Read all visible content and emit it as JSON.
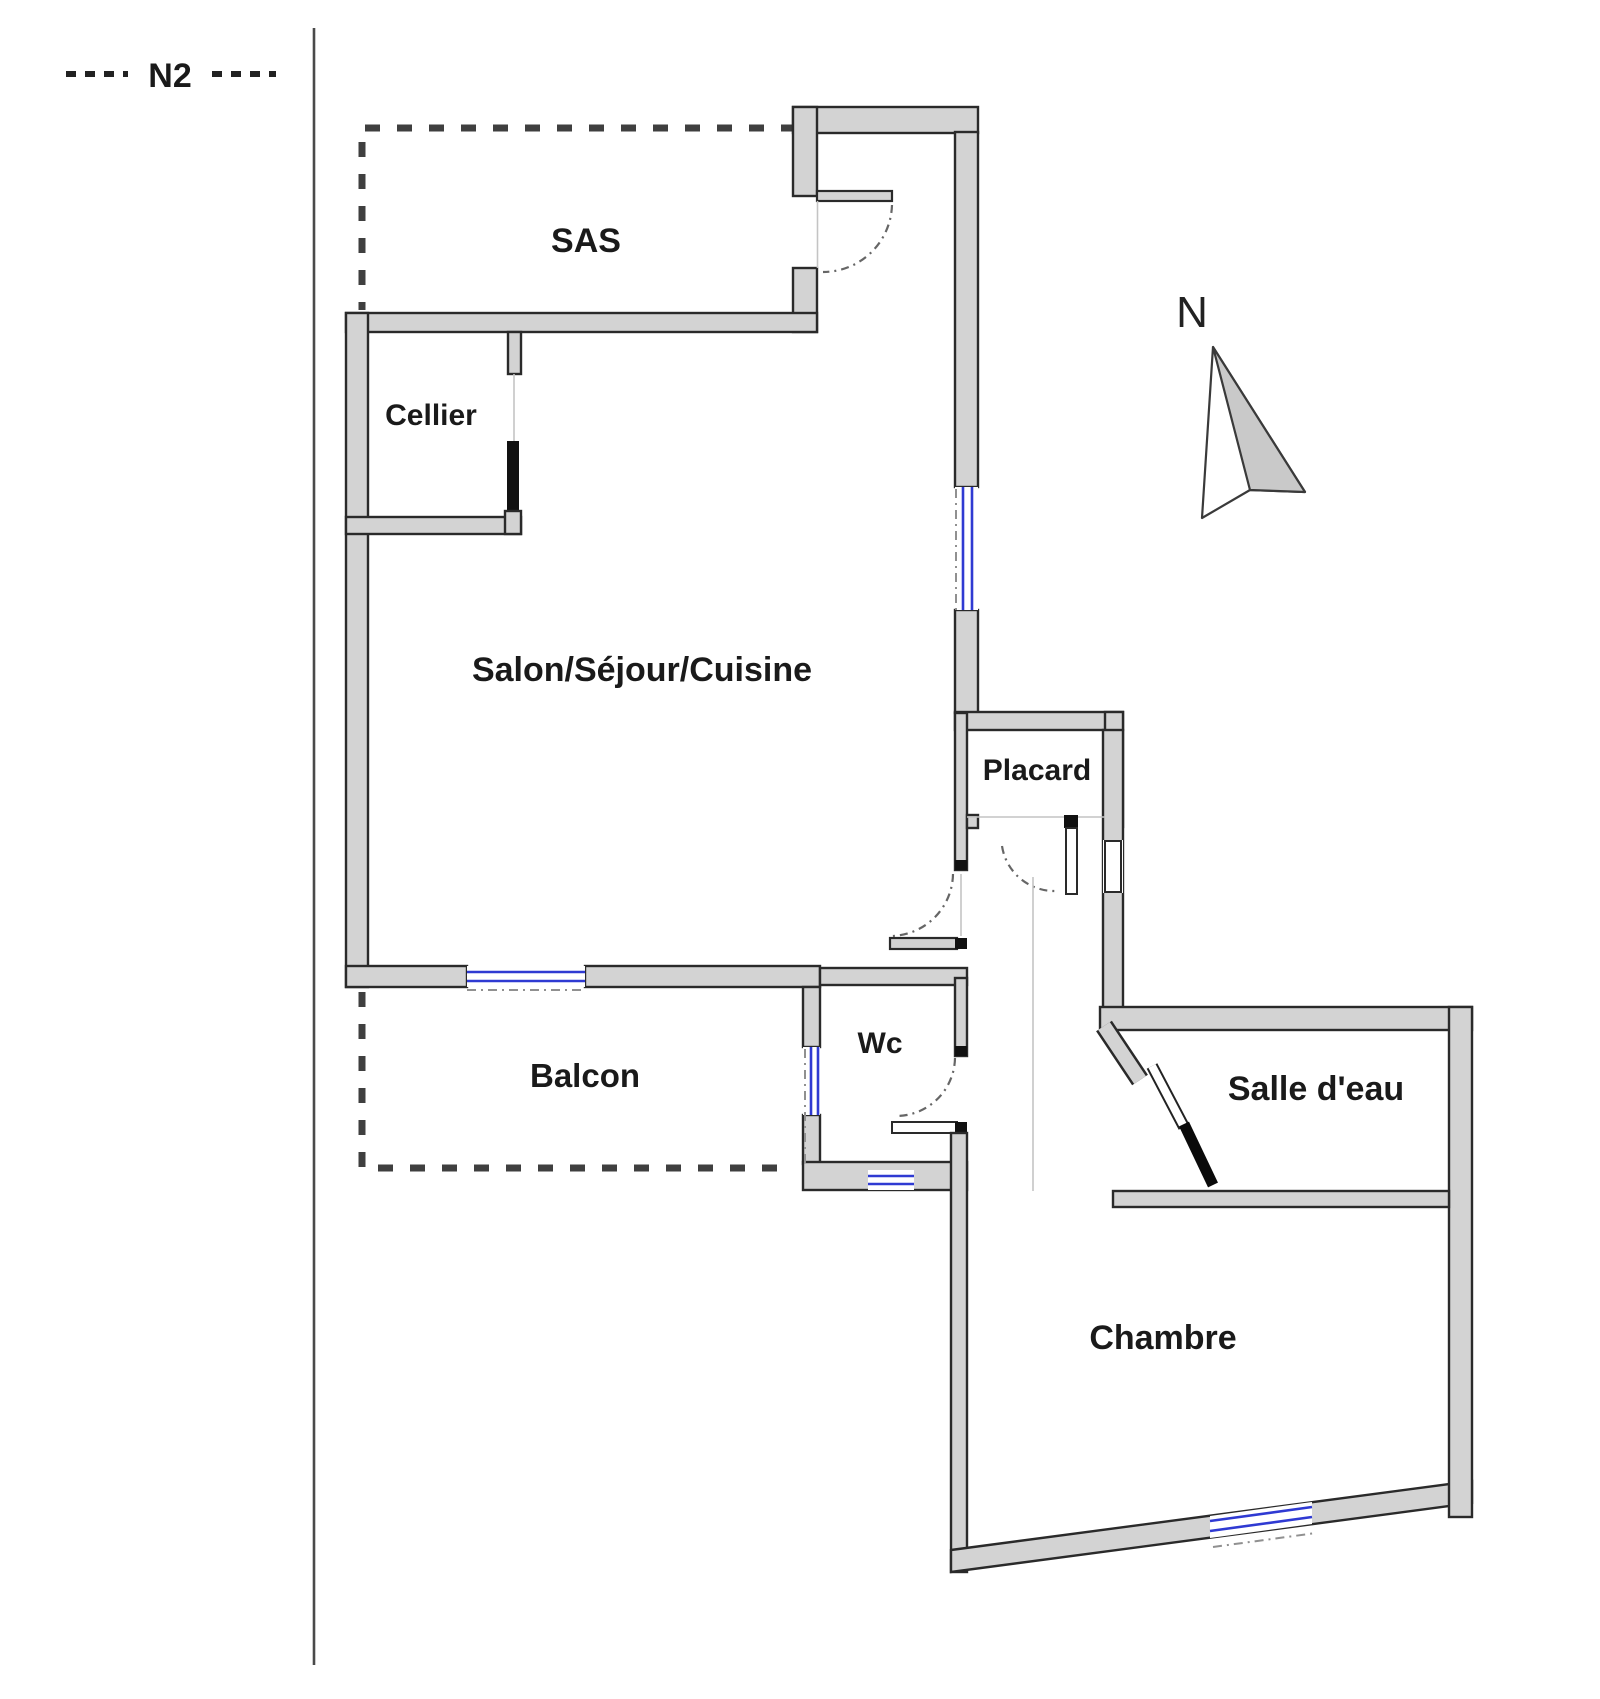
{
  "plan": {
    "annotation": {
      "label": "N2"
    },
    "compass": {
      "label": "N"
    },
    "rooms": [
      {
        "id": "sas",
        "label": "SAS",
        "dashed_boundary": true
      },
      {
        "id": "cellier",
        "label": "Cellier",
        "dashed_boundary": false
      },
      {
        "id": "salon",
        "label": "Salon/Séjour/Cuisine",
        "dashed_boundary": false
      },
      {
        "id": "placard",
        "label": "Placard",
        "dashed_boundary": false
      },
      {
        "id": "balcon",
        "label": "Balcon",
        "dashed_boundary": true
      },
      {
        "id": "wc",
        "label": "Wc",
        "dashed_boundary": false
      },
      {
        "id": "salle_deau",
        "label": "Salle d'eau",
        "dashed_boundary": false
      },
      {
        "id": "chambre",
        "label": "Chambre",
        "dashed_boundary": false
      }
    ],
    "colors": {
      "wall_fill": "#d3d3d3",
      "wall_stroke": "#2a2a2a",
      "window": "#2f3ad2",
      "dashed_boundary": "#3f3f3f",
      "door_arc": "#666666",
      "text": "#1a1a1a"
    }
  }
}
